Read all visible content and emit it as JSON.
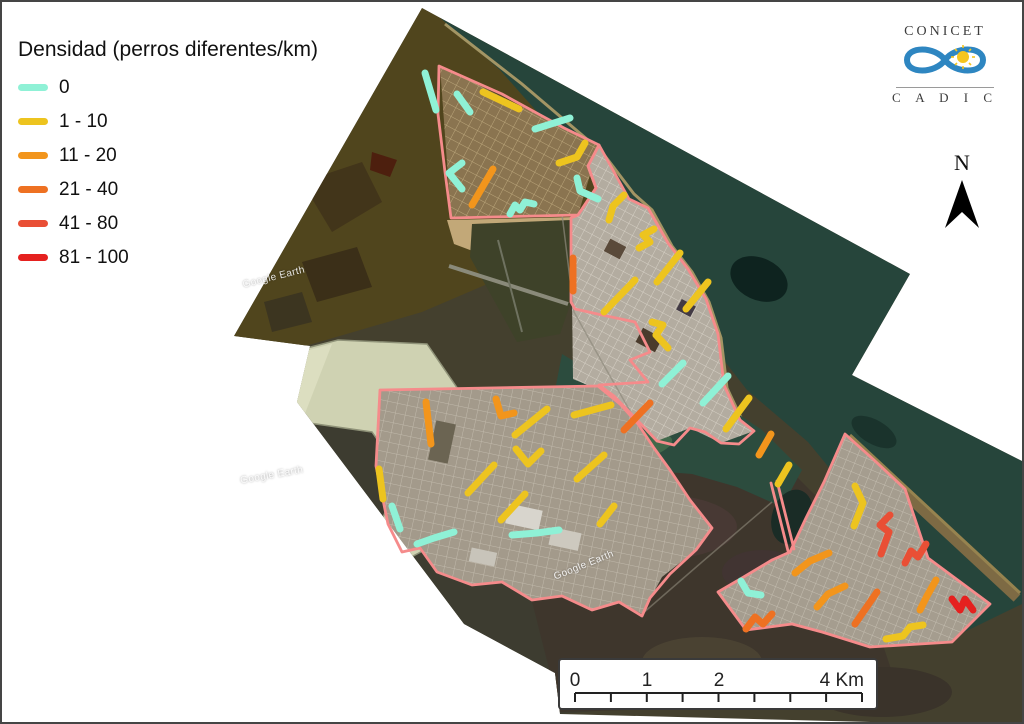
{
  "legend": {
    "title": "Densidad (perros diferentes/km)",
    "items": [
      {
        "label": "0",
        "color": "#8FF1D6"
      },
      {
        "label": "1 - 10",
        "color": "#EDC41F"
      },
      {
        "label": "11 - 20",
        "color": "#F2951C"
      },
      {
        "label": "21 - 40",
        "color": "#EE7122"
      },
      {
        "label": "41 - 80",
        "color": "#E94F35"
      },
      {
        "label": "81 - 100",
        "color": "#E5211F"
      }
    ]
  },
  "logo": {
    "line1": "CONICET",
    "line2": "C A D I C"
  },
  "north_label": "N",
  "scale_bar": {
    "labels": [
      "0",
      "1",
      "2",
      "4 Km"
    ]
  },
  "watermark_text": "Google Earth",
  "map": {
    "boundary_color": "#F58B8B",
    "category_colors": [
      "#8FF1D6",
      "#EDC41F",
      "#F2951C",
      "#EE7122",
      "#E94F35",
      "#E5211F"
    ],
    "watermarks": [
      {
        "x": 240,
        "y": 270,
        "rot": -14
      },
      {
        "x": 238,
        "y": 468,
        "rot": -10
      },
      {
        "x": 550,
        "y": 558,
        "rot": -22
      }
    ],
    "boundaries": [
      {
        "closed": true,
        "pts": [
          [
            437,
            64
          ],
          [
            500,
            92
          ],
          [
            562,
            126
          ],
          [
            597,
            143
          ],
          [
            586,
            164
          ],
          [
            594,
            186
          ],
          [
            576,
            213
          ],
          [
            449,
            216
          ],
          [
            443,
            170
          ],
          [
            436,
            112
          ]
        ]
      },
      {
        "closed": true,
        "pts": [
          [
            597,
            143
          ],
          [
            612,
            170
          ],
          [
            627,
            197
          ],
          [
            646,
            206
          ],
          [
            666,
            241
          ],
          [
            686,
            267
          ],
          [
            704,
            297
          ],
          [
            716,
            332
          ],
          [
            722,
            383
          ],
          [
            738,
            418
          ],
          [
            752,
            429
          ],
          [
            737,
            442
          ],
          [
            719,
            441
          ],
          [
            703,
            430
          ],
          [
            688,
            426
          ],
          [
            672,
            443
          ],
          [
            655,
            439
          ],
          [
            637,
            420
          ],
          [
            612,
            394
          ],
          [
            597,
            383
          ],
          [
            646,
            380
          ],
          [
            628,
            358
          ],
          [
            648,
            350
          ],
          [
            633,
            320
          ],
          [
            600,
            313
          ],
          [
            573,
            307
          ],
          [
            569,
            300
          ],
          [
            569,
            216
          ],
          [
            576,
            213
          ],
          [
            594,
            186
          ],
          [
            586,
            164
          ]
        ]
      },
      {
        "closed": true,
        "pts": [
          [
            378,
            388
          ],
          [
            596,
            384
          ],
          [
            618,
            402
          ],
          [
            636,
            422
          ],
          [
            652,
            446
          ],
          [
            668,
            468
          ],
          [
            688,
            498
          ],
          [
            710,
            526
          ],
          [
            694,
            548
          ],
          [
            668,
            572
          ],
          [
            648,
            596
          ],
          [
            640,
            614
          ],
          [
            617,
            600
          ],
          [
            590,
            608
          ],
          [
            560,
            594
          ],
          [
            530,
            598
          ],
          [
            500,
            580
          ],
          [
            470,
            583
          ],
          [
            435,
            570
          ],
          [
            418,
            546
          ],
          [
            400,
            550
          ],
          [
            386,
            522
          ],
          [
            374,
            464
          ]
        ]
      },
      {
        "closed": false,
        "pts": [
          [
            769,
            481
          ],
          [
            786,
            549
          ]
        ]
      },
      {
        "closed": false,
        "pts": [
          [
            775,
            479
          ],
          [
            792,
            547
          ]
        ]
      },
      {
        "closed": true,
        "pts": [
          [
            843,
            432
          ],
          [
            872,
            458
          ],
          [
            903,
            487
          ],
          [
            926,
            556
          ],
          [
            988,
            602
          ],
          [
            950,
            640
          ],
          [
            868,
            645
          ],
          [
            820,
            630
          ],
          [
            790,
            622
          ],
          [
            744,
            628
          ],
          [
            716,
            590
          ],
          [
            740,
            576
          ],
          [
            770,
            558
          ],
          [
            788,
            550
          ],
          [
            804,
            516
          ],
          [
            822,
            480
          ]
        ]
      }
    ],
    "segments": [
      {
        "c": 0,
        "p": [
          [
            423,
            71
          ],
          [
            434,
            108
          ]
        ]
      },
      {
        "c": 0,
        "p": [
          [
            455,
            92
          ],
          [
            468,
            110
          ]
        ]
      },
      {
        "c": 1,
        "p": [
          [
            481,
            90
          ],
          [
            517,
            107
          ]
        ]
      },
      {
        "c": 0,
        "p": [
          [
            533,
            127
          ],
          [
            568,
            116
          ]
        ]
      },
      {
        "c": 1,
        "p": [
          [
            583,
            141
          ],
          [
            575,
            155
          ],
          [
            557,
            161
          ]
        ]
      },
      {
        "c": 0,
        "p": [
          [
            575,
            176
          ],
          [
            578,
            189
          ],
          [
            596,
            197
          ]
        ]
      },
      {
        "c": 1,
        "p": [
          [
            622,
            193
          ],
          [
            611,
            204
          ],
          [
            607,
            218
          ]
        ]
      },
      {
        "c": 0,
        "p": [
          [
            460,
            161
          ],
          [
            447,
            171
          ],
          [
            460,
            187
          ]
        ]
      },
      {
        "c": 2,
        "p": [
          [
            491,
            167
          ],
          [
            470,
            203
          ]
        ]
      },
      {
        "c": 0,
        "p": [
          [
            508,
            212
          ],
          [
            513,
            203
          ],
          [
            518,
            208
          ],
          [
            523,
            200
          ],
          [
            532,
            202
          ]
        ]
      },
      {
        "c": 1,
        "p": [
          [
            652,
            227
          ],
          [
            641,
            233
          ],
          [
            648,
            240
          ],
          [
            637,
            246
          ]
        ]
      },
      {
        "c": 1,
        "p": [
          [
            655,
            280
          ],
          [
            678,
            251
          ]
        ]
      },
      {
        "c": 1,
        "p": [
          [
            684,
            307
          ],
          [
            706,
            280
          ]
        ]
      },
      {
        "c": 1,
        "p": [
          [
            602,
            310
          ],
          [
            633,
            278
          ]
        ]
      },
      {
        "c": 3,
        "p": [
          [
            571,
            256
          ],
          [
            571,
            289
          ]
        ]
      },
      {
        "c": 1,
        "p": [
          [
            650,
            320
          ],
          [
            661,
            323
          ],
          [
            654,
            333
          ],
          [
            666,
            346
          ]
        ]
      },
      {
        "c": 0,
        "p": [
          [
            660,
            382
          ],
          [
            681,
            361
          ]
        ]
      },
      {
        "c": 0,
        "p": [
          [
            701,
            401
          ],
          [
            726,
            374
          ]
        ]
      },
      {
        "c": 1,
        "p": [
          [
            724,
            427
          ],
          [
            747,
            396
          ]
        ]
      },
      {
        "c": 3,
        "p": [
          [
            622,
            428
          ],
          [
            648,
            401
          ]
        ]
      },
      {
        "c": 1,
        "p": [
          [
            572,
            413
          ],
          [
            609,
            403
          ]
        ]
      },
      {
        "c": 1,
        "p": [
          [
            575,
            477
          ],
          [
            602,
            453
          ]
        ]
      },
      {
        "c": 1,
        "p": [
          [
            513,
            433
          ],
          [
            545,
            407
          ]
        ]
      },
      {
        "c": 2,
        "p": [
          [
            494,
            397
          ],
          [
            499,
            414
          ],
          [
            512,
            411
          ]
        ]
      },
      {
        "c": 2,
        "p": [
          [
            424,
            400
          ],
          [
            429,
            442
          ]
        ]
      },
      {
        "c": 1,
        "p": [
          [
            514,
            447
          ],
          [
            526,
            462
          ],
          [
            539,
            449
          ]
        ]
      },
      {
        "c": 1,
        "p": [
          [
            466,
            491
          ],
          [
            492,
            463
          ]
        ]
      },
      {
        "c": 1,
        "p": [
          [
            499,
            518
          ],
          [
            523,
            492
          ]
        ]
      },
      {
        "c": 1,
        "p": [
          [
            377,
            467
          ],
          [
            381,
            497
          ]
        ]
      },
      {
        "c": 0,
        "p": [
          [
            390,
            504
          ],
          [
            398,
            527
          ]
        ]
      },
      {
        "c": 0,
        "p": [
          [
            415,
            542
          ],
          [
            432,
            536
          ],
          [
            452,
            530
          ]
        ]
      },
      {
        "c": 0,
        "p": [
          [
            510,
            533
          ],
          [
            535,
            531
          ],
          [
            557,
            528
          ]
        ]
      },
      {
        "c": 1,
        "p": [
          [
            598,
            522
          ],
          [
            612,
            504
          ]
        ]
      },
      {
        "c": 2,
        "p": [
          [
            769,
            432
          ],
          [
            757,
            453
          ]
        ]
      },
      {
        "c": 1,
        "p": [
          [
            787,
            463
          ],
          [
            776,
            482
          ]
        ]
      },
      {
        "c": 1,
        "p": [
          [
            853,
            484
          ],
          [
            861,
            501
          ],
          [
            852,
            524
          ]
        ]
      },
      {
        "c": 4,
        "p": [
          [
            888,
            513
          ],
          [
            878,
            523
          ],
          [
            887,
            530
          ],
          [
            879,
            552
          ]
        ]
      },
      {
        "c": 4,
        "p": [
          [
            924,
            542
          ],
          [
            916,
            555
          ],
          [
            909,
            549
          ],
          [
            903,
            561
          ]
        ]
      },
      {
        "c": 2,
        "p": [
          [
            793,
            571
          ],
          [
            808,
            559
          ],
          [
            827,
            551
          ]
        ]
      },
      {
        "c": 2,
        "p": [
          [
            815,
            605
          ],
          [
            826,
            592
          ],
          [
            843,
            584
          ]
        ]
      },
      {
        "c": 3,
        "p": [
          [
            875,
            590
          ],
          [
            853,
            622
          ]
        ]
      },
      {
        "c": 2,
        "p": [
          [
            934,
            578
          ],
          [
            925,
            594
          ],
          [
            918,
            608
          ]
        ]
      },
      {
        "c": 5,
        "p": [
          [
            950,
            597
          ],
          [
            958,
            608
          ],
          [
            963,
            597
          ],
          [
            971,
            608
          ]
        ]
      },
      {
        "c": 0,
        "p": [
          [
            739,
            579
          ],
          [
            746,
            591
          ],
          [
            759,
            593
          ]
        ]
      },
      {
        "c": 3,
        "p": [
          [
            744,
            627
          ],
          [
            753,
            615
          ],
          [
            761,
            622
          ],
          [
            770,
            612
          ]
        ]
      },
      {
        "c": 1,
        "p": [
          [
            884,
            637
          ],
          [
            901,
            634
          ],
          [
            908,
            625
          ],
          [
            921,
            623
          ]
        ]
      }
    ]
  }
}
